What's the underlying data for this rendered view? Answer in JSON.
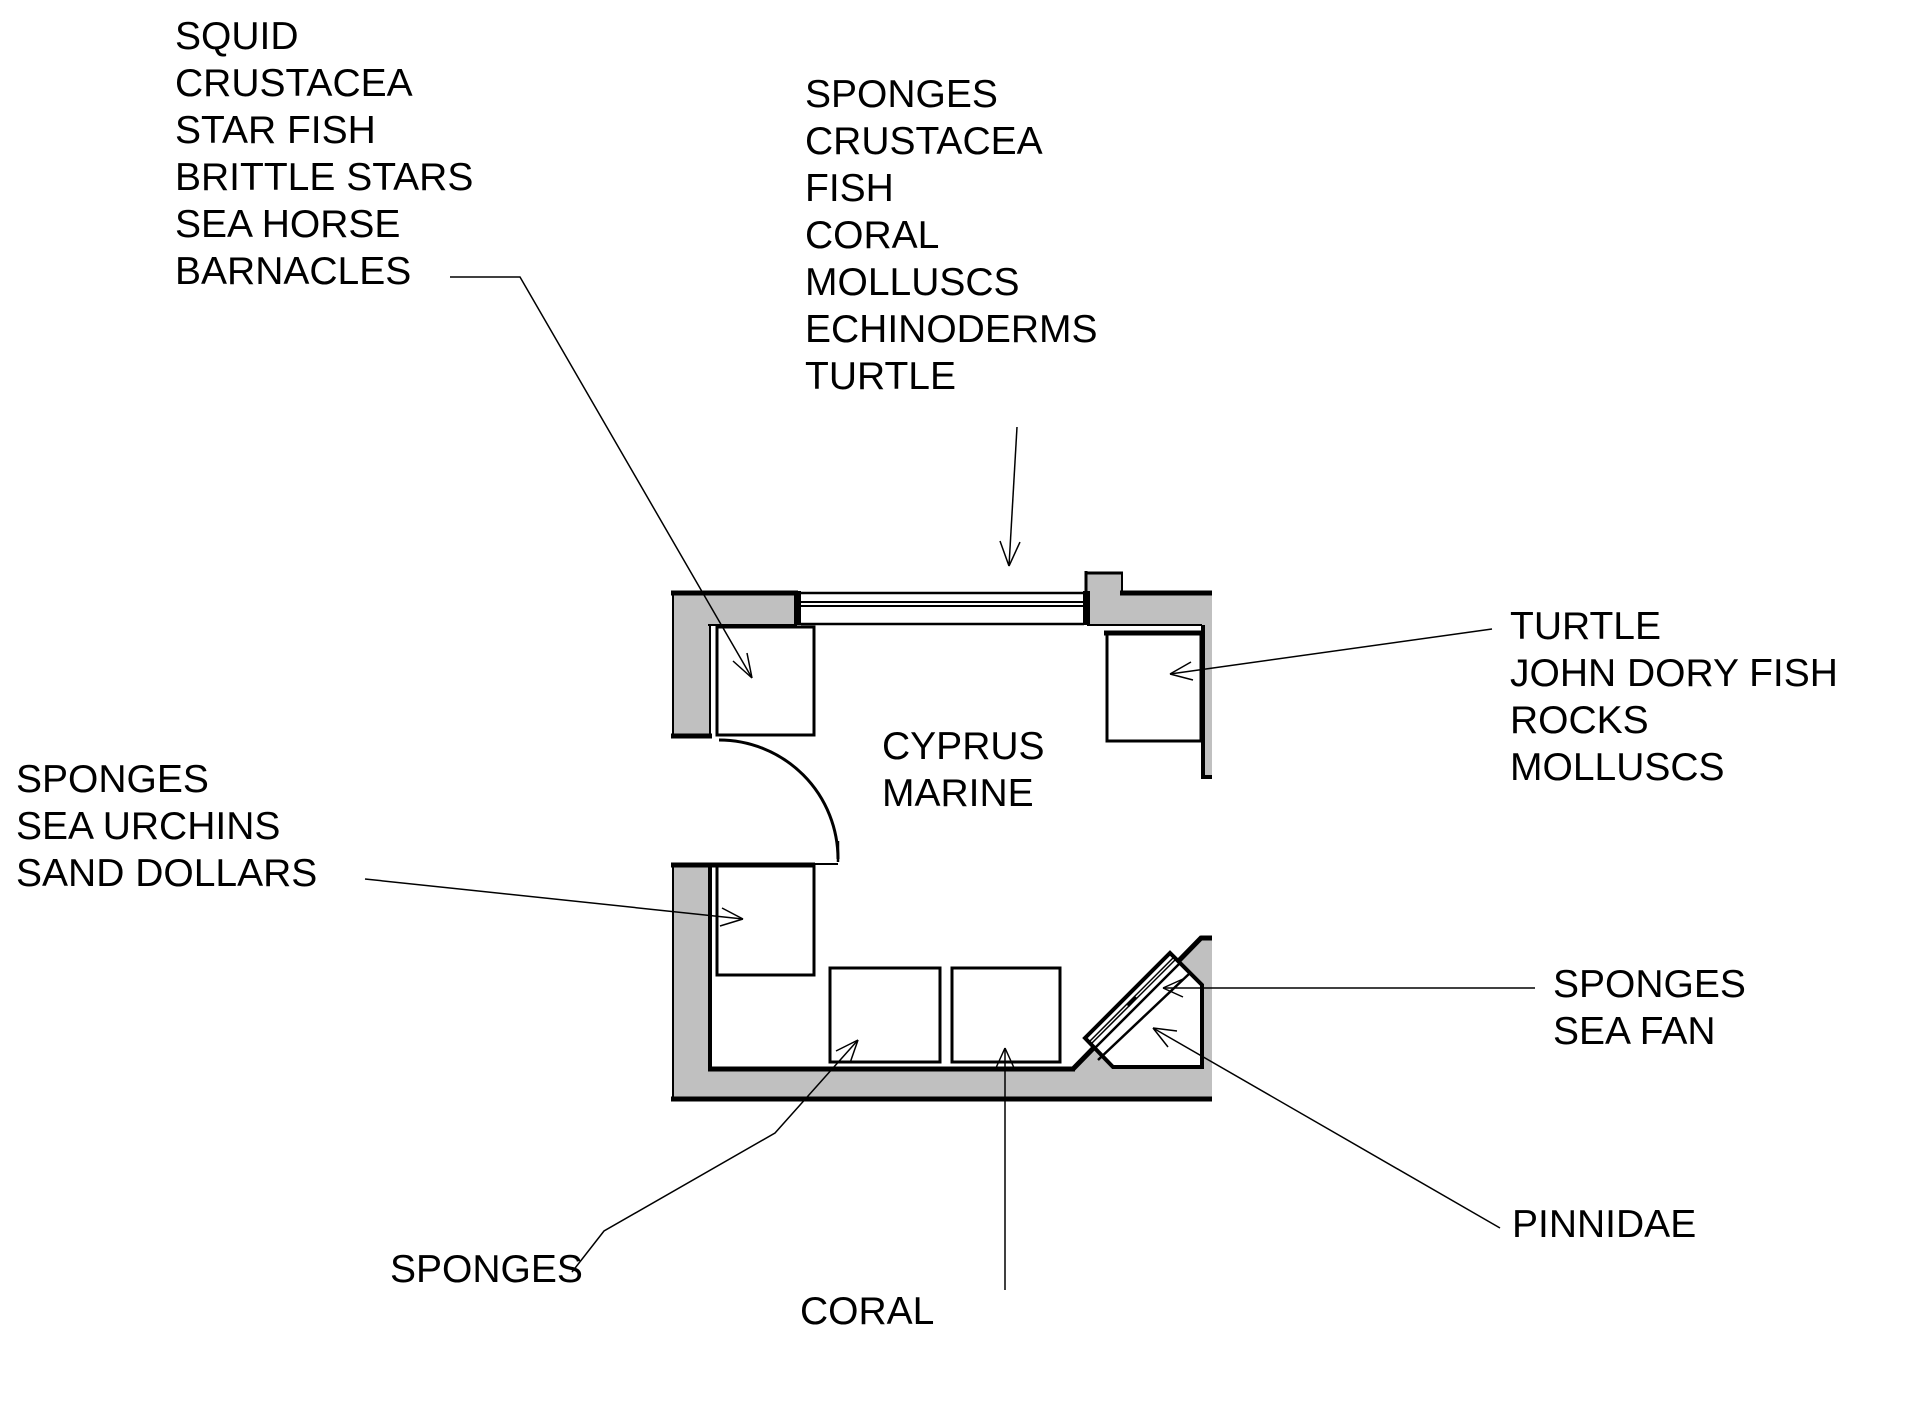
{
  "diagram_title": "CYPRUS MARINE exhibit floor plan",
  "room_label": {
    "lines": [
      "CYPRUS",
      "MARINE"
    ]
  },
  "labels": {
    "top_left": {
      "lines": [
        "SQUID",
        "CRUSTACEA",
        "STAR FISH",
        "BRITTLE STARS",
        "SEA HORSE",
        "BARNACLES"
      ]
    },
    "top_center": {
      "lines": [
        "SPONGES",
        "CRUSTACEA",
        "FISH",
        "CORAL",
        "MOLLUSCS",
        "ECHINODERMS",
        "TURTLE"
      ]
    },
    "right": {
      "lines": [
        "TURTLE",
        "JOHN DORY FISH",
        "ROCKS",
        "MOLLUSCS"
      ]
    },
    "left": {
      "lines": [
        "SPONGES",
        "SEA URCHINS",
        "SAND DOLLARS"
      ]
    },
    "sea_fan": {
      "lines": [
        "SPONGES",
        "SEA FAN"
      ]
    },
    "pinnidae": {
      "lines": [
        "PINNIDAE"
      ]
    },
    "sponges_bottom": {
      "lines": [
        "SPONGES"
      ]
    },
    "coral_bottom": {
      "lines": [
        "CORAL"
      ]
    }
  },
  "colors": {
    "wall_fill": "#c0c0c0",
    "line": "#000000",
    "background": "#ffffff"
  }
}
